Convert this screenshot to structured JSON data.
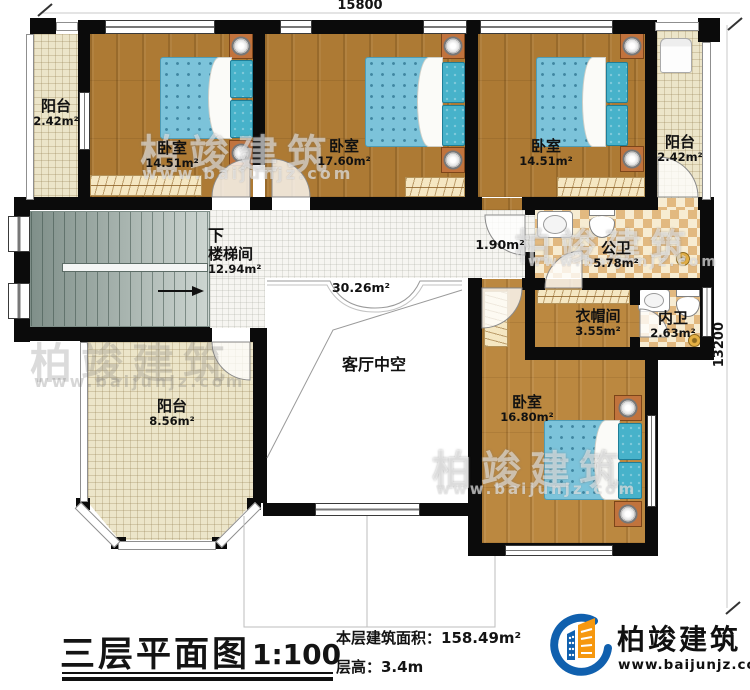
{
  "plan": {
    "dim_width": "15800",
    "dim_height": "13200",
    "rooms": {
      "balcony_tl": {
        "name": "阳台",
        "area": "2.42m²"
      },
      "bedroom_1": {
        "name": "卧室",
        "area": "14.51m²"
      },
      "bedroom_2": {
        "name": "卧室",
        "area": "17.60m²"
      },
      "bedroom_3": {
        "name": "卧室",
        "area": "14.51m²"
      },
      "balcony_tr": {
        "name": "阳台",
        "area": "2.42m²"
      },
      "stairwell": {
        "direction": "下",
        "name": "楼梯间",
        "area": "12.94m²"
      },
      "hallway": {
        "area": "30.26m²"
      },
      "passage": {
        "area": "1.90m²"
      },
      "public_bathroom": {
        "name": "公卫",
        "area": "5.78m²"
      },
      "cloakroom": {
        "name": "衣帽间",
        "area": "3.55m²"
      },
      "ensuite_bathroom": {
        "name": "内卫",
        "area": "2.63m²"
      },
      "bedroom_4": {
        "name": "卧室",
        "area": "16.80m²"
      },
      "balcony_bl": {
        "name": "阳台",
        "area": "8.56m²"
      },
      "living_void": {
        "name": "客厅中空"
      }
    }
  },
  "titleblock": {
    "title": "三层平面图",
    "scale": "1:100",
    "floor_area": "本层建筑面积：158.49m²",
    "floor_height": "层高：3.4m"
  },
  "brand": {
    "name": "柏竣建筑",
    "url": "www.baijunjz.com"
  }
}
